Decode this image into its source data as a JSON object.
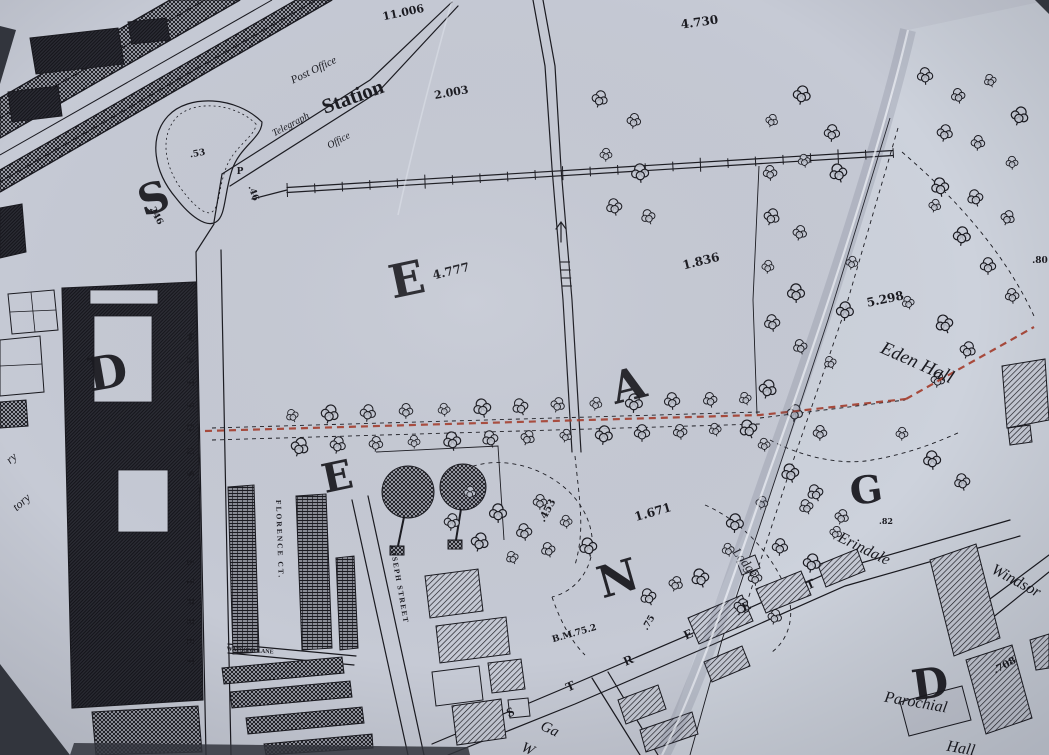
{
  "meta": {
    "title": "Photographed Ordnance Survey town map with red route annotation"
  },
  "colors": {
    "paper": "#c6cad6",
    "paper_light": "#d4d8e3",
    "ink": "#1a1a20",
    "red_line": "#a83a28",
    "photo_bg": "#32353d"
  },
  "map_labels": [
    {
      "id": "num-11006",
      "text": "11.006",
      "x": 404,
      "y": 16,
      "rot": -12,
      "size": 11,
      "cls": "num"
    },
    {
      "id": "num-4730",
      "text": "4.730",
      "x": 700,
      "y": 26,
      "rot": -8,
      "size": 12,
      "cls": "num"
    },
    {
      "id": "num-2003",
      "text": "2.003",
      "x": 452,
      "y": 96,
      "rot": -10,
      "size": 11,
      "cls": "num"
    },
    {
      "id": "post-office",
      "text": "Post Office",
      "x": 315,
      "y": 73,
      "rot": -26,
      "size": 11,
      "cls": "estate"
    },
    {
      "id": "station",
      "text": "Station",
      "x": 355,
      "y": 103,
      "rot": -20,
      "size": 21,
      "cls": "place"
    },
    {
      "id": "telegraph",
      "text": "Telegraph",
      "x": 292,
      "y": 127,
      "rot": -28,
      "size": 10,
      "cls": "estate"
    },
    {
      "id": "telegraph-office",
      "text": "Office",
      "x": 340,
      "y": 143,
      "rot": -28,
      "size": 10,
      "cls": "estate"
    },
    {
      "id": "num-53",
      "text": ".53",
      "x": 198,
      "y": 156,
      "rot": -10,
      "size": 9,
      "cls": "num"
    },
    {
      "id": "p-mark",
      "text": "P",
      "x": 240,
      "y": 174,
      "rot": 0,
      "size": 9,
      "cls": "num"
    },
    {
      "id": "num-46",
      "text": ".46",
      "x": 251,
      "y": 194,
      "rot": 70,
      "size": 9,
      "cls": "num"
    },
    {
      "id": "num-246",
      "text": "246",
      "x": 154,
      "y": 217,
      "rot": 62,
      "size": 9,
      "cls": "num"
    },
    {
      "id": "big-letter-s",
      "text": "S",
      "x": 158,
      "y": 212,
      "rot": -18,
      "size": 42,
      "cls": "big"
    },
    {
      "id": "big-letter-e1",
      "text": "E",
      "x": 410,
      "y": 295,
      "rot": -12,
      "size": 46,
      "cls": "big"
    },
    {
      "id": "num-4777",
      "text": "4.777",
      "x": 452,
      "y": 275,
      "rot": -14,
      "size": 12,
      "cls": "num"
    },
    {
      "id": "num-1836",
      "text": "1.836",
      "x": 702,
      "y": 265,
      "rot": -14,
      "size": 12,
      "cls": "num"
    },
    {
      "id": "num-80",
      "text": ".80",
      "x": 1040,
      "y": 263,
      "rot": 0,
      "size": 9,
      "cls": "num"
    },
    {
      "id": "num-5298",
      "text": "5.298",
      "x": 886,
      "y": 303,
      "rot": -12,
      "size": 12,
      "cls": "num"
    },
    {
      "id": "eden-hall",
      "text": "Eden Hall",
      "x": 915,
      "y": 368,
      "rot": 24,
      "size": 19,
      "cls": "estate"
    },
    {
      "id": "big-letter-d1",
      "text": "D",
      "x": 110,
      "y": 388,
      "rot": -10,
      "size": 46,
      "cls": "big"
    },
    {
      "id": "big-letter-a",
      "text": "A",
      "x": 632,
      "y": 400,
      "rot": -14,
      "size": 44,
      "cls": "big"
    },
    {
      "id": "big-letter-e2",
      "text": "E",
      "x": 340,
      "y": 490,
      "rot": -12,
      "size": 40,
      "cls": "big"
    },
    {
      "id": "big-letter-g",
      "text": "G",
      "x": 868,
      "y": 503,
      "rot": -8,
      "size": 38,
      "cls": "big"
    },
    {
      "id": "num-82",
      "text": ".82",
      "x": 886,
      "y": 524,
      "rot": 0,
      "size": 8,
      "cls": "num"
    },
    {
      "id": "num-453",
      "text": ".453",
      "x": 550,
      "y": 512,
      "rot": -62,
      "size": 10,
      "cls": "num"
    },
    {
      "id": "num-1671",
      "text": "1.671",
      "x": 654,
      "y": 516,
      "rot": -16,
      "size": 12,
      "cls": "num"
    },
    {
      "id": "erindale",
      "text": "Erindale",
      "x": 862,
      "y": 553,
      "rot": 26,
      "size": 16,
      "cls": "estate"
    },
    {
      "id": "lodge",
      "text": "Lodge",
      "x": 742,
      "y": 565,
      "rot": 52,
      "size": 13,
      "cls": "estate"
    },
    {
      "id": "windsor",
      "text": "Windsor",
      "x": 1014,
      "y": 585,
      "rot": 28,
      "size": 16,
      "cls": "estate"
    },
    {
      "id": "big-letter-n",
      "text": "N",
      "x": 622,
      "y": 593,
      "rot": -16,
      "size": 44,
      "cls": "big"
    },
    {
      "id": "num-75",
      "text": ".75",
      "x": 651,
      "y": 624,
      "rot": -60,
      "size": 9,
      "cls": "num"
    },
    {
      "id": "bm-752",
      "text": "B.M.75.2",
      "x": 575,
      "y": 636,
      "rot": -16,
      "size": 9,
      "cls": "num"
    },
    {
      "id": "big-letter-d2",
      "text": "D",
      "x": 932,
      "y": 698,
      "rot": -8,
      "size": 42,
      "cls": "big"
    },
    {
      "id": "num-708",
      "text": ".708",
      "x": 1006,
      "y": 668,
      "rot": -28,
      "size": 10,
      "cls": "num"
    },
    {
      "id": "parochial",
      "text": "Parochial",
      "x": 915,
      "y": 707,
      "rot": 10,
      "size": 16,
      "cls": "estate"
    },
    {
      "id": "parochial-hall",
      "text": "Hall",
      "x": 960,
      "y": 753,
      "rot": 10,
      "size": 16,
      "cls": "estate"
    },
    {
      "id": "street-watsons-1",
      "text": "WATSONS",
      "x": 187,
      "y": 332,
      "rot": 90,
      "size": 10,
      "ls": 16,
      "anchor": "start",
      "cls": "street"
    },
    {
      "id": "street-watsons-2",
      "text": "STREET",
      "x": 187,
      "y": 560,
      "rot": 90,
      "size": 10,
      "ls": 13,
      "anchor": "start",
      "cls": "street"
    },
    {
      "id": "street-florence",
      "text": "FLORENCE CT.",
      "x": 276,
      "y": 500,
      "rot": 88,
      "size": 7.5,
      "ls": 2,
      "anchor": "start",
      "cls": "street"
    },
    {
      "id": "street-joseph",
      "text": "JOSEPH STREET",
      "x": 390,
      "y": 545,
      "rot": 80,
      "size": 7.5,
      "ls": 1.5,
      "anchor": "start",
      "cls": "street"
    },
    {
      "id": "street-watsons-lane",
      "text": "WATSONS LANE",
      "x": 250,
      "y": 652,
      "rot": 4,
      "size": 6,
      "cls": "street"
    },
    {
      "id": "road-letter-s",
      "text": "S",
      "x": 512,
      "y": 716,
      "rot": -24,
      "size": 13,
      "cls": "roadletter"
    },
    {
      "id": "road-letter-t1",
      "text": "T",
      "x": 572,
      "y": 690,
      "rot": -24,
      "size": 13,
      "cls": "roadletter"
    },
    {
      "id": "road-letter-r",
      "text": "R",
      "x": 630,
      "y": 664,
      "rot": -24,
      "size": 13,
      "cls": "roadletter"
    },
    {
      "id": "road-letter-e1",
      "text": "E",
      "x": 690,
      "y": 638,
      "rot": -24,
      "size": 13,
      "cls": "roadletter"
    },
    {
      "id": "road-letter-e2",
      "text": "E",
      "x": 748,
      "y": 610,
      "rot": -24,
      "size": 13,
      "cls": "roadletter"
    },
    {
      "id": "road-letter-t2",
      "text": "T",
      "x": 812,
      "y": 588,
      "rot": -24,
      "size": 13,
      "cls": "roadletter"
    },
    {
      "id": "gas-works-ga",
      "text": "Ga",
      "x": 548,
      "y": 733,
      "rot": 25,
      "size": 15,
      "cls": "estate"
    },
    {
      "id": "gas-works-w",
      "text": "W",
      "x": 526,
      "y": 753,
      "rot": 25,
      "size": 15,
      "cls": "estate"
    },
    {
      "id": "factory-fragment-ry",
      "text": "ry",
      "x": 14,
      "y": 461,
      "rot": -42,
      "size": 12,
      "cls": "estate"
    },
    {
      "id": "factory-fragment-tory",
      "text": "tory",
      "x": 24,
      "y": 505,
      "rot": -42,
      "size": 12,
      "cls": "estate"
    }
  ]
}
